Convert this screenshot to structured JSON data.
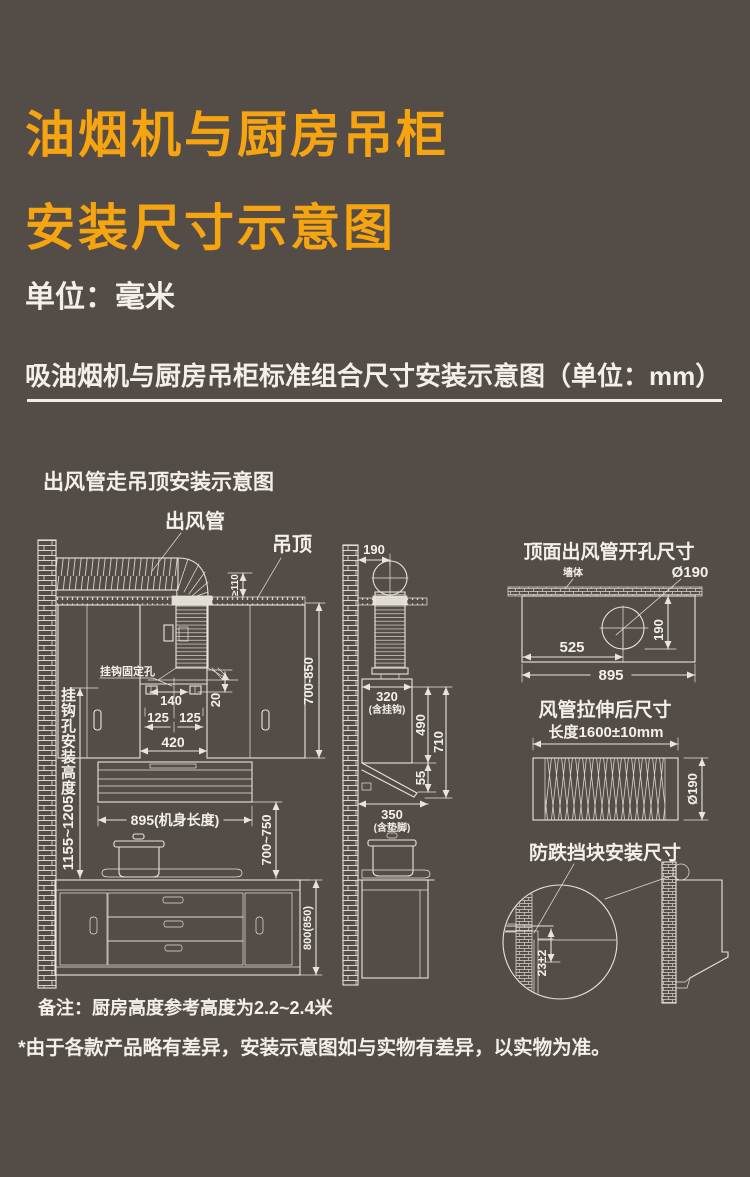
{
  "theme": {
    "background": "#544c46",
    "accent_orange": "#f7a411",
    "line_color": "#e8e4dc",
    "text_color": "#f3f0ea"
  },
  "header": {
    "title_line1": "油烟机与厨房吊柜",
    "title_line2": "安装尺寸示意图",
    "unit_label": "单位：毫米",
    "subtitle": "吸油烟机与厨房吊柜标准组合尺寸安装示意图（单位：mm）"
  },
  "ceiling_install_diagram": {
    "title": "出风管走吊顶安装示意图",
    "duct_label": "出风管",
    "ceiling_label": "吊顶",
    "min_clearance": "≥110",
    "hook_hole_label": "挂钩固定孔",
    "hook_spacing": "140",
    "hook_offset_left": "125",
    "hook_offset_right": "125",
    "hook_drop": "20",
    "recess_width": "420",
    "body_length": "895(机身长度)",
    "hook_height_label": "挂钩孔安装高度",
    "hook_height_range": "1155~1205",
    "hood_to_counter": "700~750",
    "wall_cabinet_height": "700-850",
    "base_cabinet_height": "800(850)"
  },
  "side_view": {
    "duct_center_offset": "190",
    "top_depth": "320",
    "top_depth_note": "(含挂钩)",
    "body_height": "490",
    "total_height": "710",
    "canopy_height": "55",
    "bottom_depth": "350",
    "bottom_depth_note": "(含垫脚)"
  },
  "top_opening_diagram": {
    "title": "顶面出风管开孔尺寸",
    "wall_label": "墙体",
    "hole_diameter": "Ø190",
    "hole_center_x": "525",
    "hole_center_y": "190",
    "panel_width": "895"
  },
  "stretched_duct_diagram": {
    "title": "风管拉伸后尺寸",
    "length": "长度1600±10mm",
    "diameter": "Ø190"
  },
  "stop_block_diagram": {
    "title": "防跌挡块安装尺寸",
    "offset": "23±2"
  },
  "notes": {
    "remark": "备注：厨房高度参考高度为2.2~2.4米",
    "disclaimer": "*由于各款产品略有差异，安装示意图如与实物有差异，以实物为准。"
  }
}
